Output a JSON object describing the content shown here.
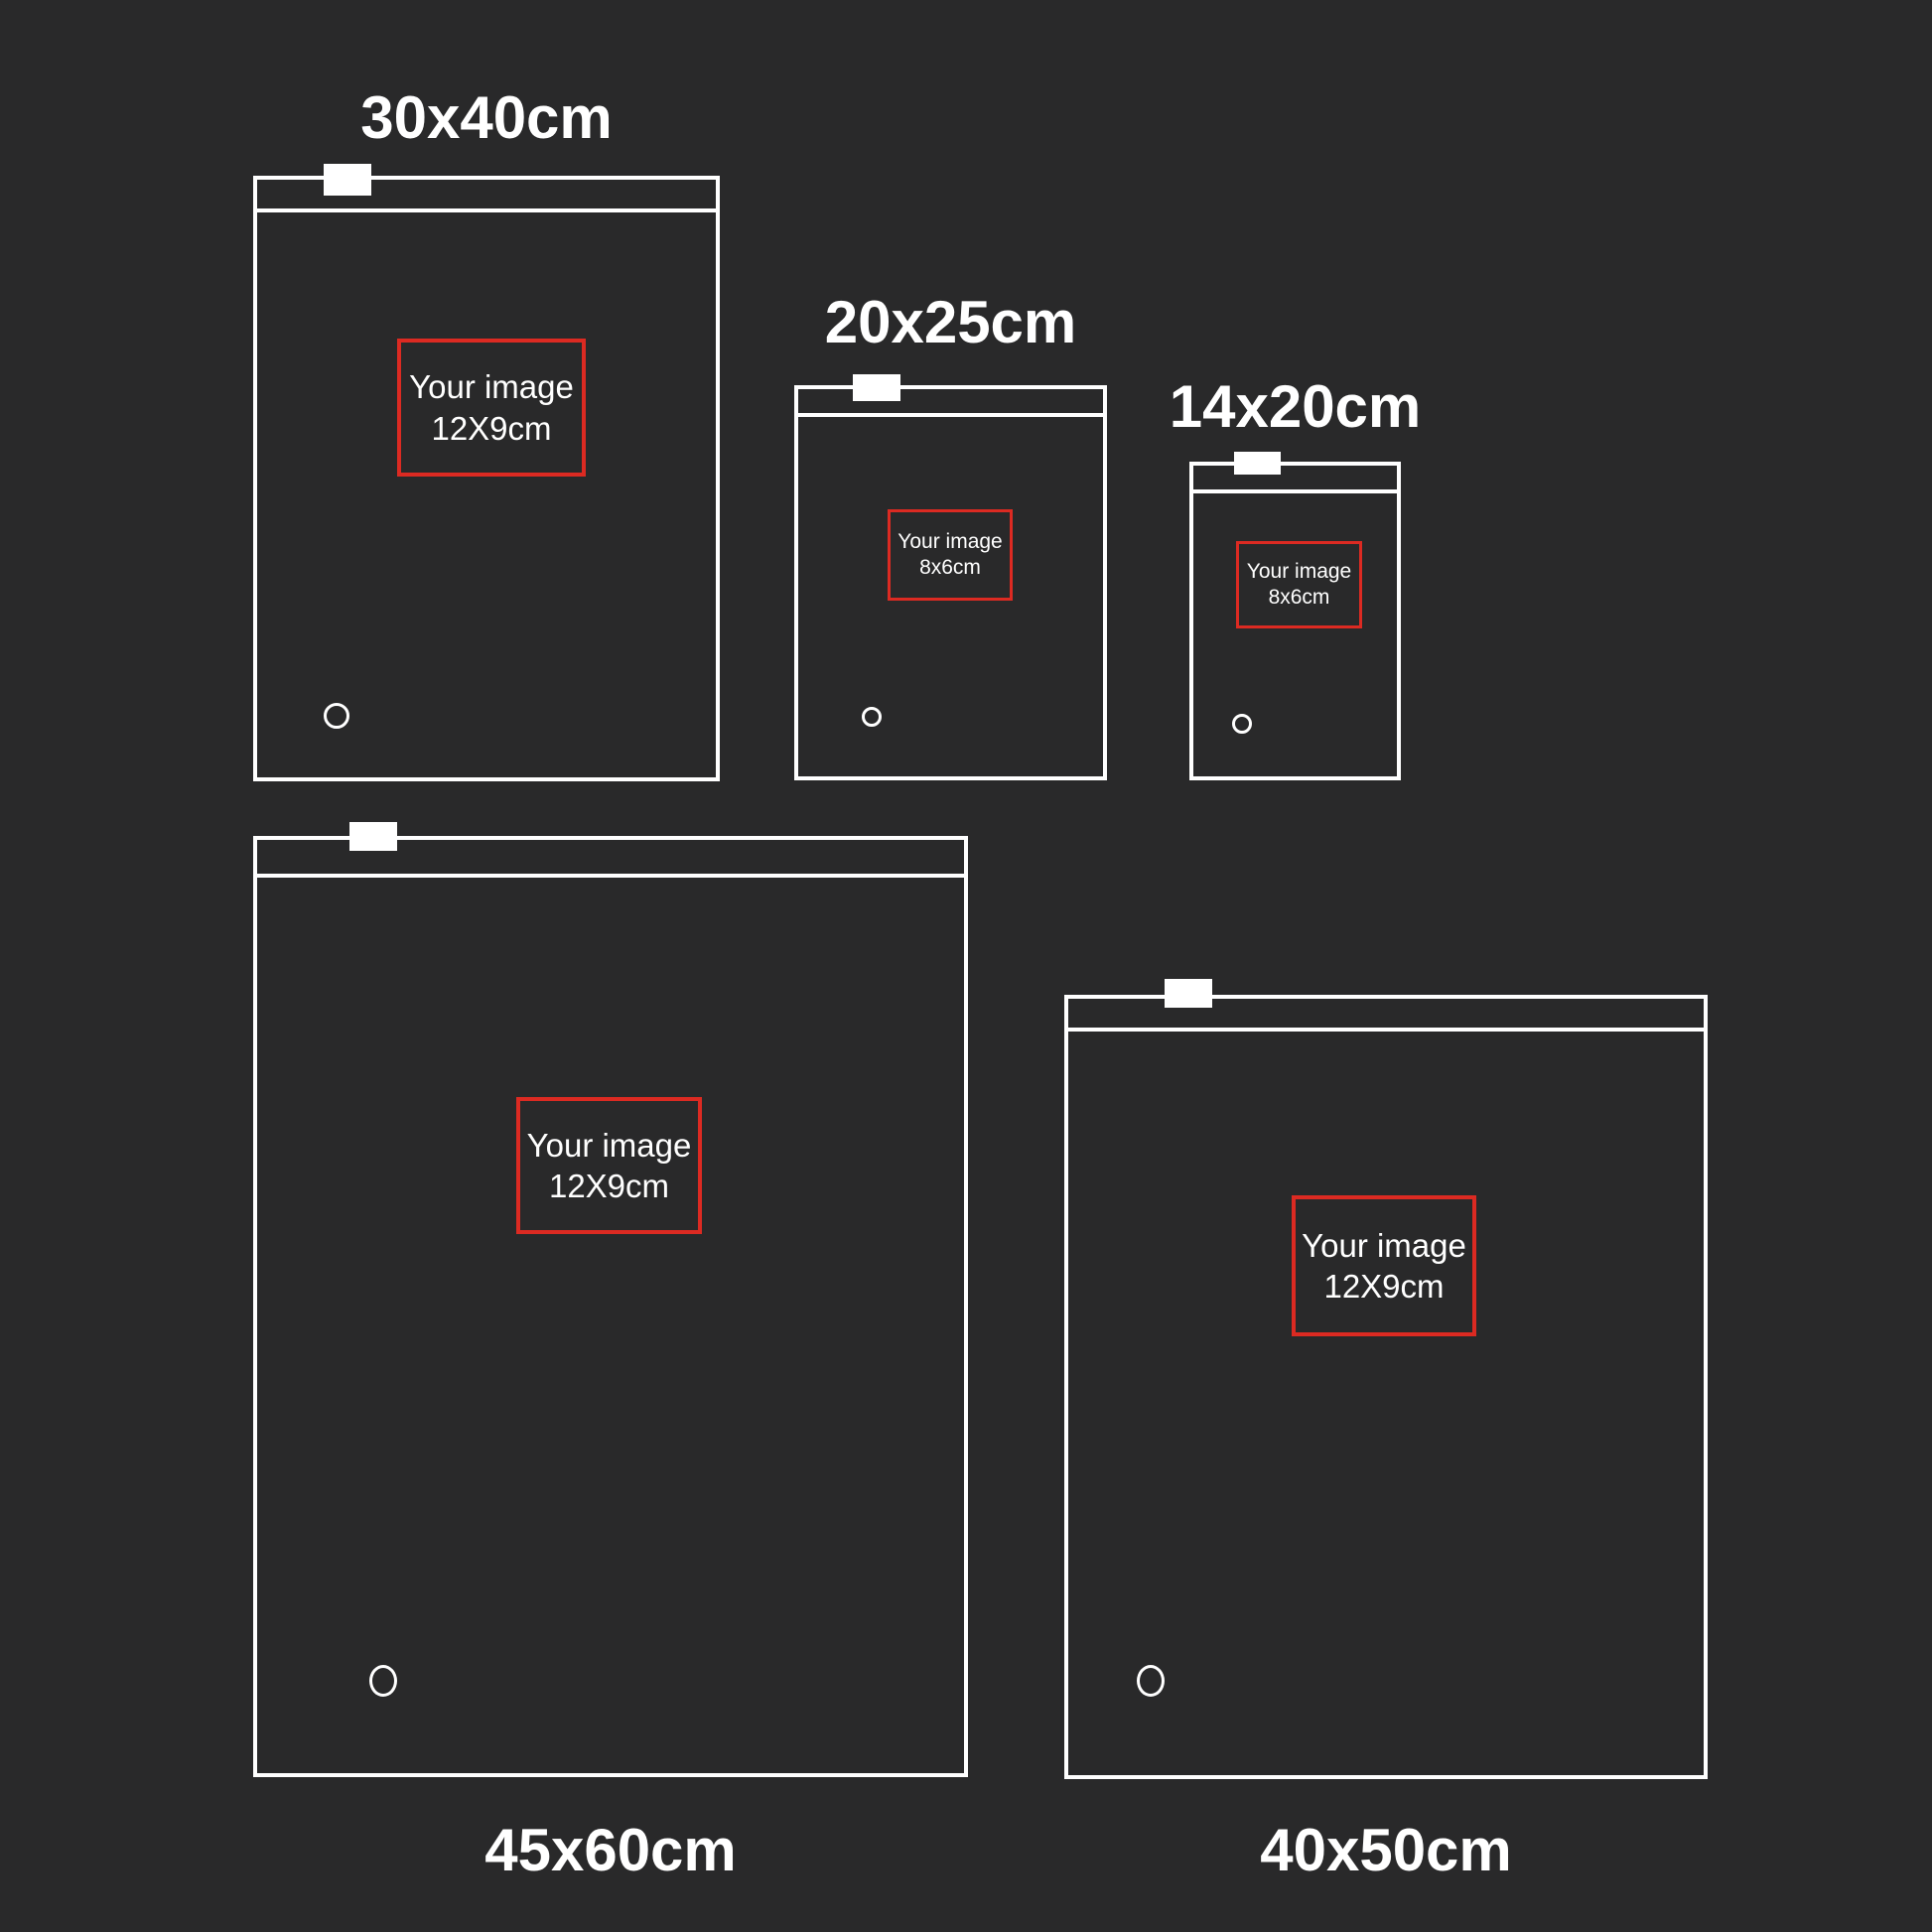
{
  "colors": {
    "background": "#29292a",
    "outline": "#ffffff",
    "accent_red": "#dc2a22",
    "text": "#ffffff"
  },
  "bags": [
    {
      "id": "30x40",
      "size_label": "30x40cm",
      "image_line1": "Your image",
      "image_line2": "12X9cm"
    },
    {
      "id": "20x25",
      "size_label": "20x25cm",
      "image_line1": "Your image",
      "image_line2": "8x6cm"
    },
    {
      "id": "14x20",
      "size_label": "14x20cm",
      "image_line1": "Your image",
      "image_line2": "8x6cm"
    },
    {
      "id": "45x60",
      "size_label": "45x60cm",
      "image_line1": "Your image",
      "image_line2": "12X9cm"
    },
    {
      "id": "40x50",
      "size_label": "40x50cm",
      "image_line1": "Your image",
      "image_line2": "12X9cm"
    }
  ]
}
